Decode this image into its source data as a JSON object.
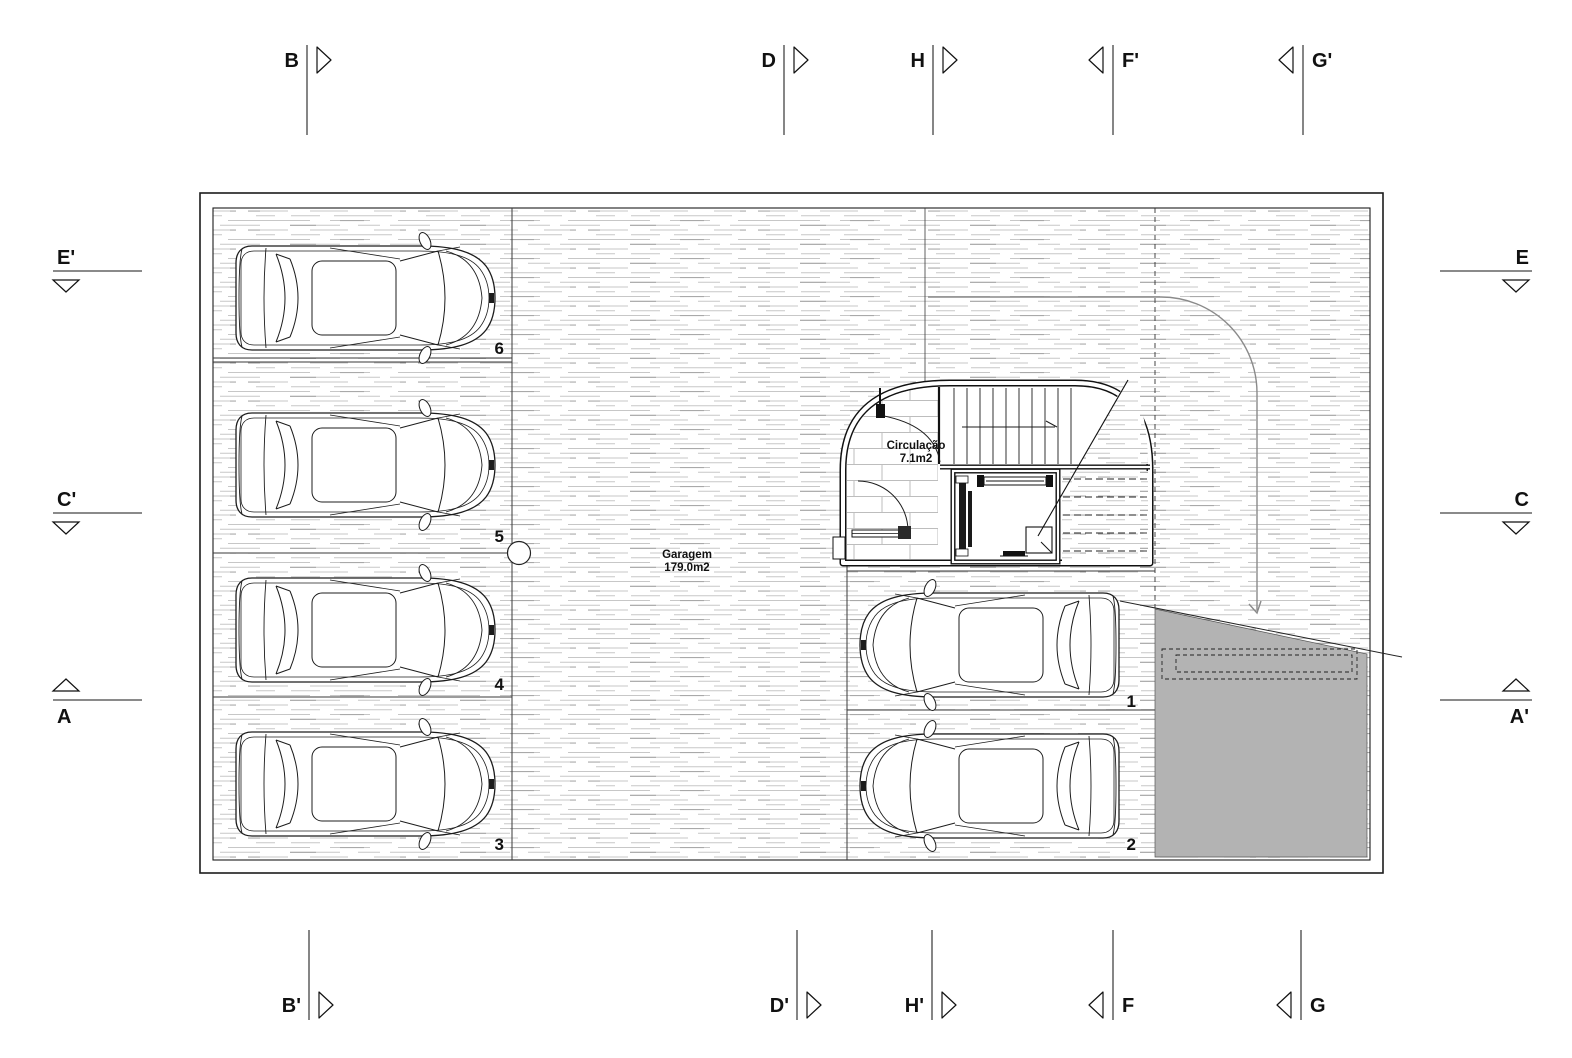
{
  "drawing": {
    "sections": {
      "top": {
        "b": "B",
        "d": "D",
        "h": "H",
        "f2": "F'",
        "g2": "G'"
      },
      "bottom": {
        "b2": "B'",
        "d2": "D'",
        "h2": "H'",
        "f": "F",
        "g": "G"
      },
      "left": {
        "e2": "E'",
        "c2": "C'",
        "a": "A"
      },
      "right": {
        "e": "E",
        "c": "C",
        "a2": "A'"
      }
    },
    "room_labels": {
      "garage": {
        "name": "Garagem",
        "area": "179.0m2"
      },
      "circulation": {
        "name": "Circulação",
        "area": "7.1m2"
      }
    },
    "parking_numbers": {
      "p1": "1",
      "p2": "2",
      "p3": "3",
      "p4": "4",
      "p5": "5",
      "p6": "6"
    },
    "colors": {
      "line": "#1c1c1c",
      "ramp_gray": "#b3b3b3",
      "hatch_gray": "#c7c7c7"
    }
  }
}
